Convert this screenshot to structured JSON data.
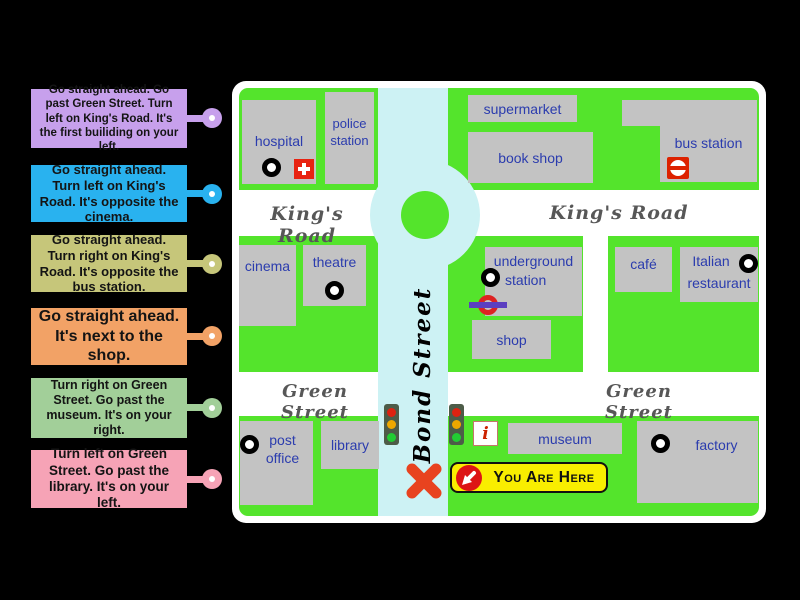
{
  "activity": {
    "instructions": [
      {
        "text": "Go straight ahead. Go past Green Street. Turn left on King's Road. It's the first builiding on your left.",
        "color": "#c7a0ec"
      },
      {
        "text": "Go straight ahead. Turn left on King's Road. It's opposite the cinema.",
        "color": "#29b2ef"
      },
      {
        "text": "Go straight ahead. Turn right on King's Road. It's opposite the bus station.",
        "color": "#c6c67a"
      },
      {
        "text": "Go straight ahead. It's next to the shop.",
        "color": "#f2a266"
      },
      {
        "text": "Turn right on Green Street. Go past the museum. It's on your right.",
        "color": "#a2cf99"
      },
      {
        "text": "Turn left on Green Street. Go past the library. It's on your left.",
        "color": "#f6a3b6"
      }
    ]
  },
  "map": {
    "streets": {
      "kings_road": "King's Road",
      "green_street": "Green Street",
      "bond_street": "Bond Street"
    },
    "places": {
      "hospital": "hospital",
      "police_station": "police\nstation",
      "supermarket": "supermarket",
      "book_shop": "book shop",
      "bus_station": "bus station",
      "cinema": "cinema",
      "theatre": "theatre",
      "underground_line1": "underground",
      "underground_line2": "station",
      "shop": "shop",
      "cafe": "café",
      "italian_line1": "Italian",
      "italian_line2": "restaurant",
      "post_office": "post\noffice",
      "library": "library",
      "museum": "museum",
      "factory": "factory"
    },
    "badge": {
      "you_are_here": "You Are Here"
    },
    "icons": {
      "info_glyph": "i"
    }
  },
  "colors": {
    "background": "#000000",
    "map_green": "#54e42c",
    "road_white": "#ffffff",
    "bond_street_cyan": "#cdf2f4",
    "building_gray": "#c3c3c3",
    "place_text_blue": "#2b3cae",
    "street_text_gray": "#575757",
    "badge_yellow": "#f9ee00",
    "alert_red": "#e43317",
    "traffic_red": "#dd2211",
    "traffic_yellow": "#eea800",
    "traffic_green": "#22cc33",
    "label_colors": [
      "#c7a0ec",
      "#29b2ef",
      "#c6c67a",
      "#f2a266",
      "#a2cf99",
      "#f6a3b6"
    ]
  }
}
